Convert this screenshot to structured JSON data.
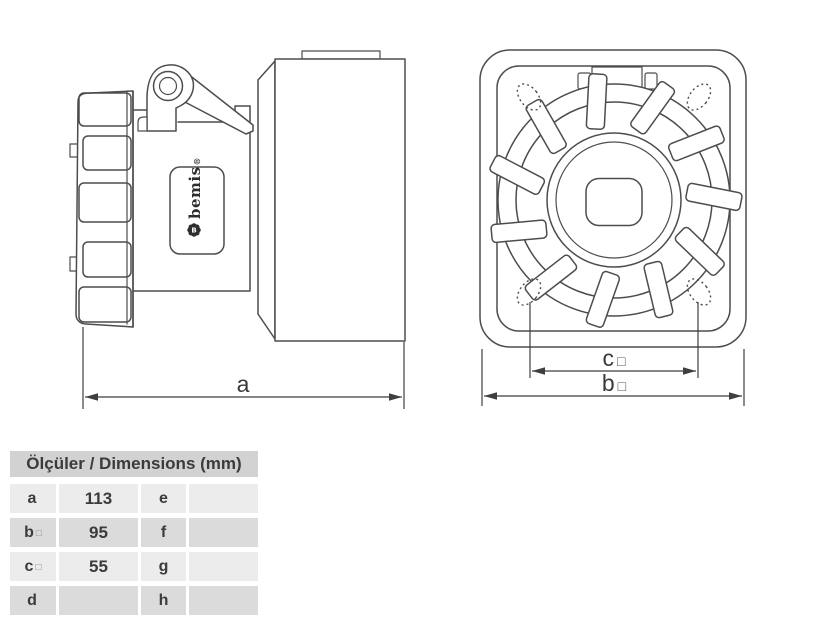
{
  "canvas": {
    "background": "#ffffff",
    "line_color": "#4d4d4d",
    "dim_text_color": "#3a3a3a",
    "table_header_bg": "#d2d2d2",
    "table_row_light_bg": "#ececec",
    "table_row_dark_bg": "#dbdbdb"
  },
  "side_view": {
    "dim_a_label": "a",
    "brand": "bemis",
    "brand_reg": "®",
    "logo_letter": "B"
  },
  "front_view": {
    "dim_c_label": "c",
    "dim_c_suffix": "□",
    "dim_b_label": "b",
    "dim_b_suffix": "□"
  },
  "table": {
    "title": "Ölçüler / Dimensions (mm)",
    "rows": [
      {
        "key1": "a",
        "key1_suffix": "",
        "value1": "113",
        "key2": "e",
        "value2": ""
      },
      {
        "key1": "b",
        "key1_suffix": "□",
        "value1": "95",
        "key2": "f",
        "value2": ""
      },
      {
        "key1": "c",
        "key1_suffix": "□",
        "value1": "55",
        "key2": "g",
        "value2": ""
      },
      {
        "key1": "d",
        "key1_suffix": "",
        "value1": "",
        "key2": "h",
        "value2": ""
      }
    ]
  }
}
